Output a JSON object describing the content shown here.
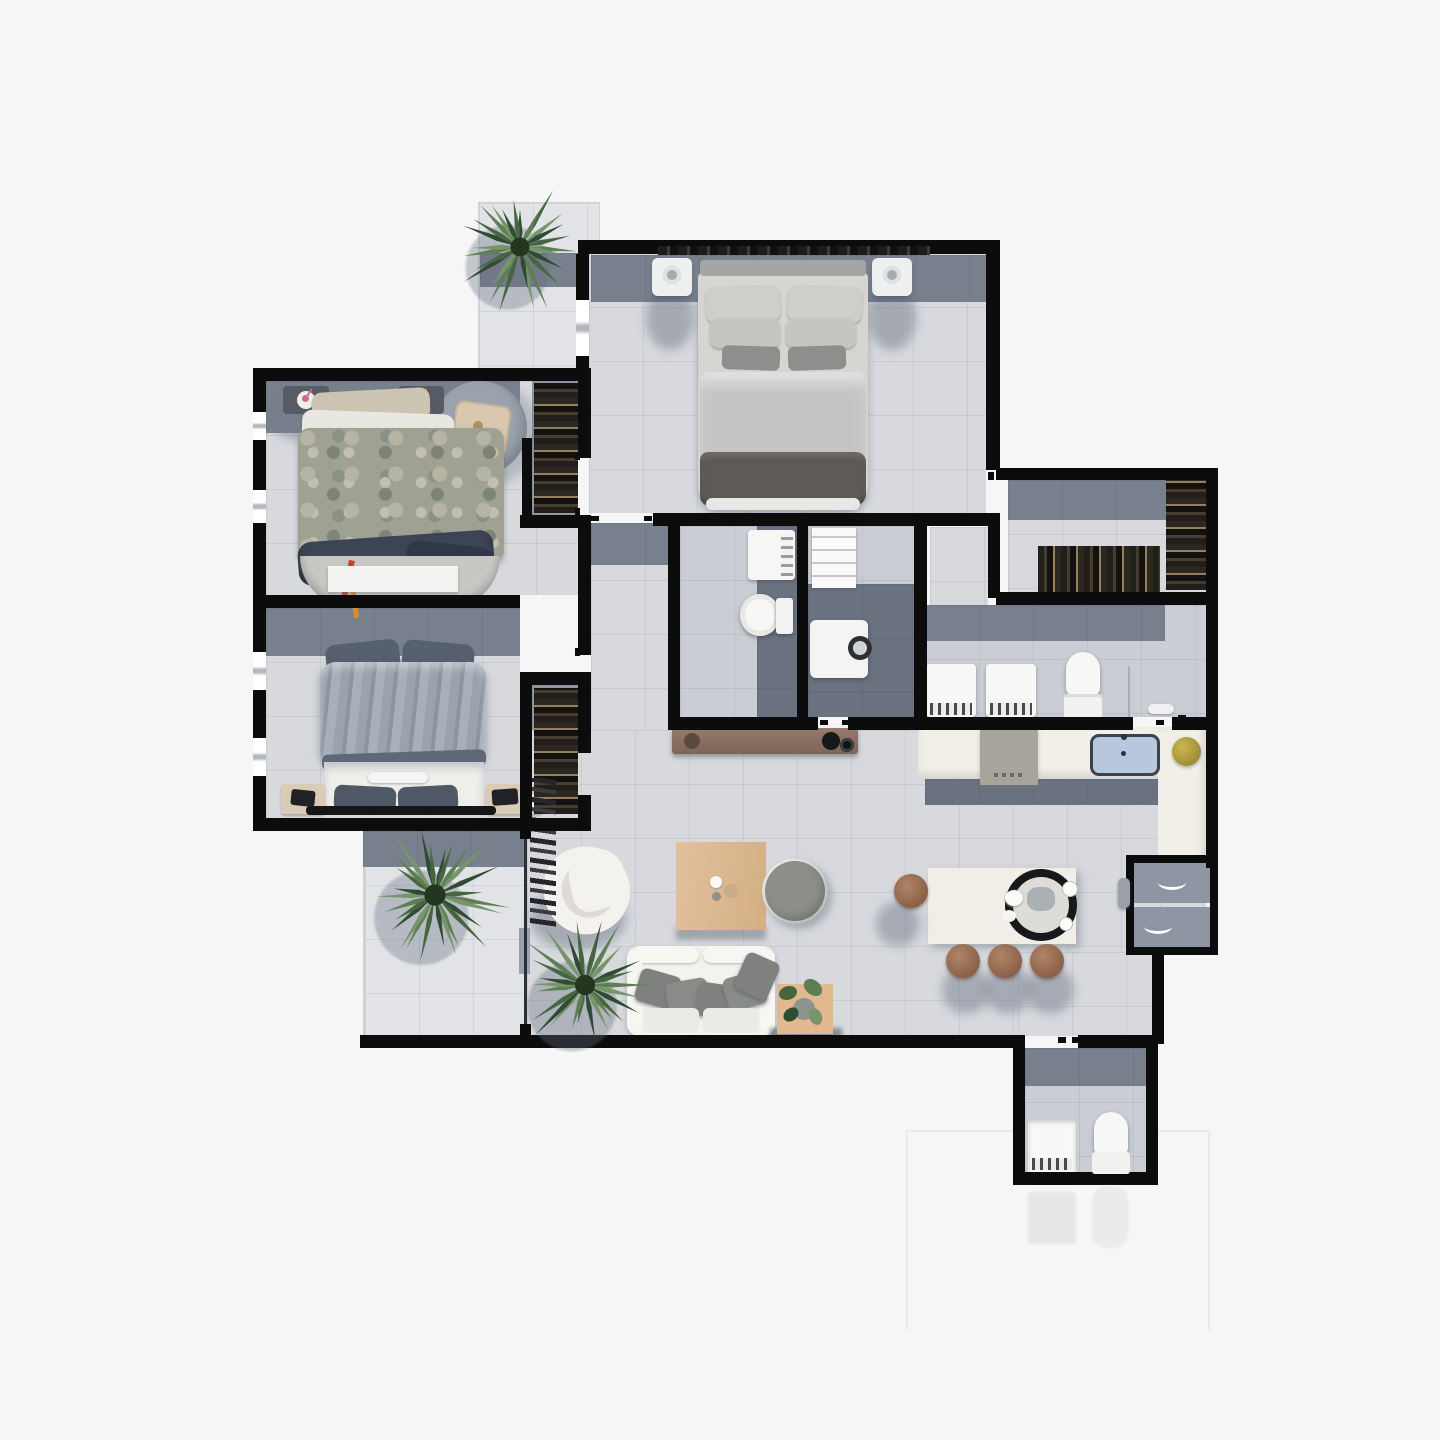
{
  "meta": {
    "title": "apartment-floor-plan-top-view",
    "text_labels": []
  },
  "palette": {
    "bg": "#f6f6f7",
    "wall": "#0c0c0c",
    "floor": "#d7d9dd",
    "floorLight": "#e2e3e6",
    "bathFloor": "#cacdd3",
    "closetFloor": "#8f96a1",
    "slate": "#78808e",
    "slateDark": "#6a7280",
    "cream": "#f2efe8",
    "white": "#f3f2ee",
    "wood": "#ddbb92",
    "woodDark": "#8a7063",
    "tan": "#e2b88e",
    "linen": "#d6d5d2",
    "throw": "#5e5b57",
    "blanket": "#9aa3ad",
    "pillowDark": "#57606e",
    "sofaPillow": "#7f817e",
    "stool": "#9b6f55",
    "fridge": "#8e96a4",
    "sinkFill": "#b9c7de",
    "sinkBorder": "#3c4350",
    "panRing": "#17181a",
    "plantGreen1": "#2f4b33",
    "plantGreen2": "#46663f",
    "plantGreen3": "#5d7f54",
    "plantGreen4": "#76956a",
    "accentOrange": "#d98a2b",
    "accentRed": "#c2442f",
    "accentPink": "#d06a8c"
  },
  "inventory": {
    "rooms": [
      {
        "id": "master-bedroom",
        "items": [
          "double-bed",
          "headboard",
          "pillows",
          "duvet",
          "dark-throw",
          "nightstand-left",
          "nightstand-right",
          "wall-frieze",
          "closet-door"
        ]
      },
      {
        "id": "balcony-top",
        "items": [
          "potted-palm"
        ]
      },
      {
        "id": "bedroom-2",
        "items": [
          "double-bed",
          "patterned-duvet",
          "jeans",
          "round-rug",
          "slippers",
          "round-table",
          "seat-cushion",
          "night-shelf-left",
          "night-shelf-right",
          "dresser",
          "closet-rack"
        ]
      },
      {
        "id": "bedroom-3",
        "items": [
          "double-bed",
          "fluffy-blanket",
          "sheet",
          "nightstand-left",
          "nightstand-right",
          "laptops",
          "bench",
          "closet-rack"
        ]
      },
      {
        "id": "wc",
        "items": [
          "vanity-sink",
          "toilet"
        ]
      },
      {
        "id": "laundry",
        "items": [
          "shelf-unit",
          "washing-machine"
        ]
      },
      {
        "id": "walk-in-closet",
        "items": [
          "clothes-rack-bottom",
          "clothes-rack-right"
        ]
      },
      {
        "id": "vanity-bathroom",
        "items": [
          "vanity-sink-1",
          "vanity-sink-2",
          "toilet",
          "glass-partition",
          "toilet-brush"
        ]
      },
      {
        "id": "kitchen",
        "items": [
          "l-counter",
          "cooktop",
          "sink",
          "fruit-bowl",
          "runner-rug",
          "island",
          "round-pan",
          "plates",
          "cups",
          "stool-1",
          "stool-2",
          "stool-3",
          "stool-4",
          "fridge-freezer"
        ]
      },
      {
        "id": "living-room",
        "items": [
          "armchair",
          "coffee-table",
          "pouf",
          "sofa",
          "sofa-pillows",
          "side-table-plant",
          "palm-plant",
          "coat-rack",
          "console-sideboard"
        ]
      },
      {
        "id": "terrace",
        "items": [
          "palm-plant",
          "glass-sliding-door"
        ]
      },
      {
        "id": "bathroom-2",
        "items": [
          "vanity-sink",
          "toilet"
        ]
      }
    ]
  }
}
